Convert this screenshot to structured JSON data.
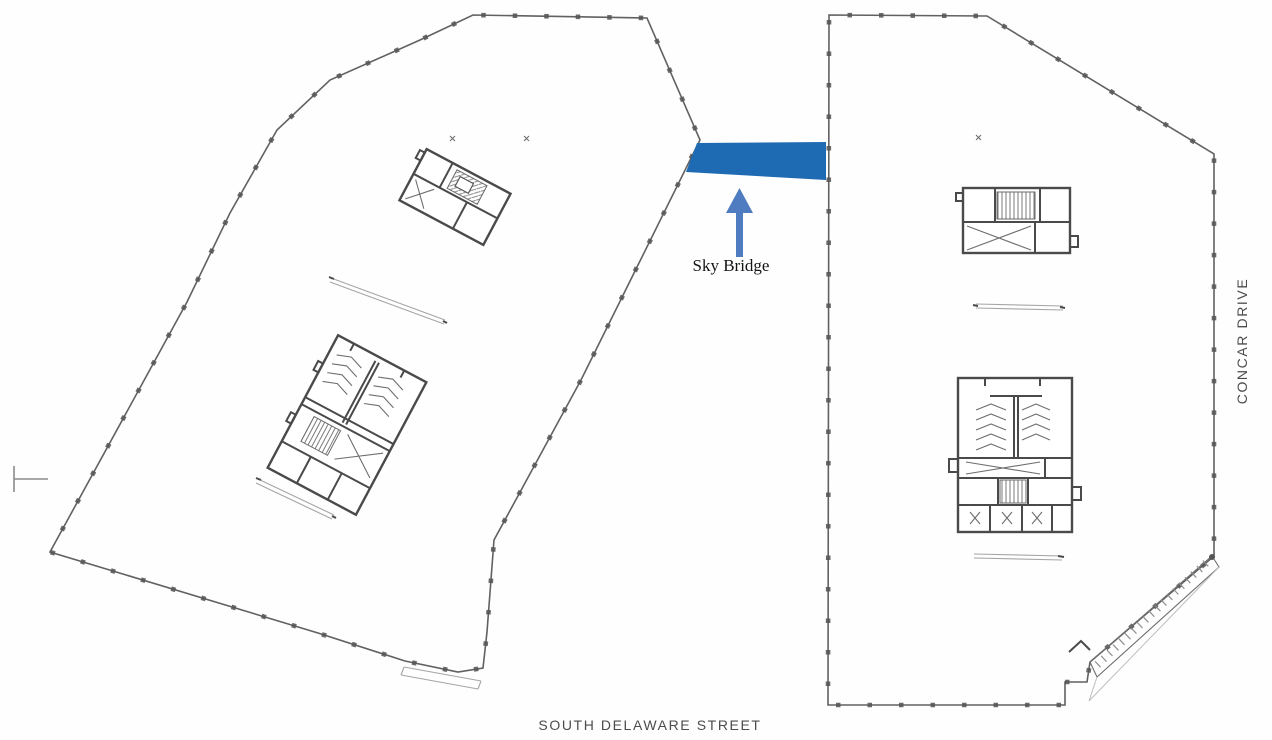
{
  "labels": {
    "sky_bridge": "Sky Bridge",
    "south_street": "SOUTH DELAWARE STREET",
    "east_street": "CONCAR DRIVE"
  },
  "colors": {
    "bridge_blue": "#1e6ab3",
    "arrow_blue": "#4f7bc0",
    "outline_gray": "#616161",
    "wall_dark": "#4a4a4a",
    "street_label_gray": "#4c4c4c",
    "annotation_black": "#141414"
  }
}
